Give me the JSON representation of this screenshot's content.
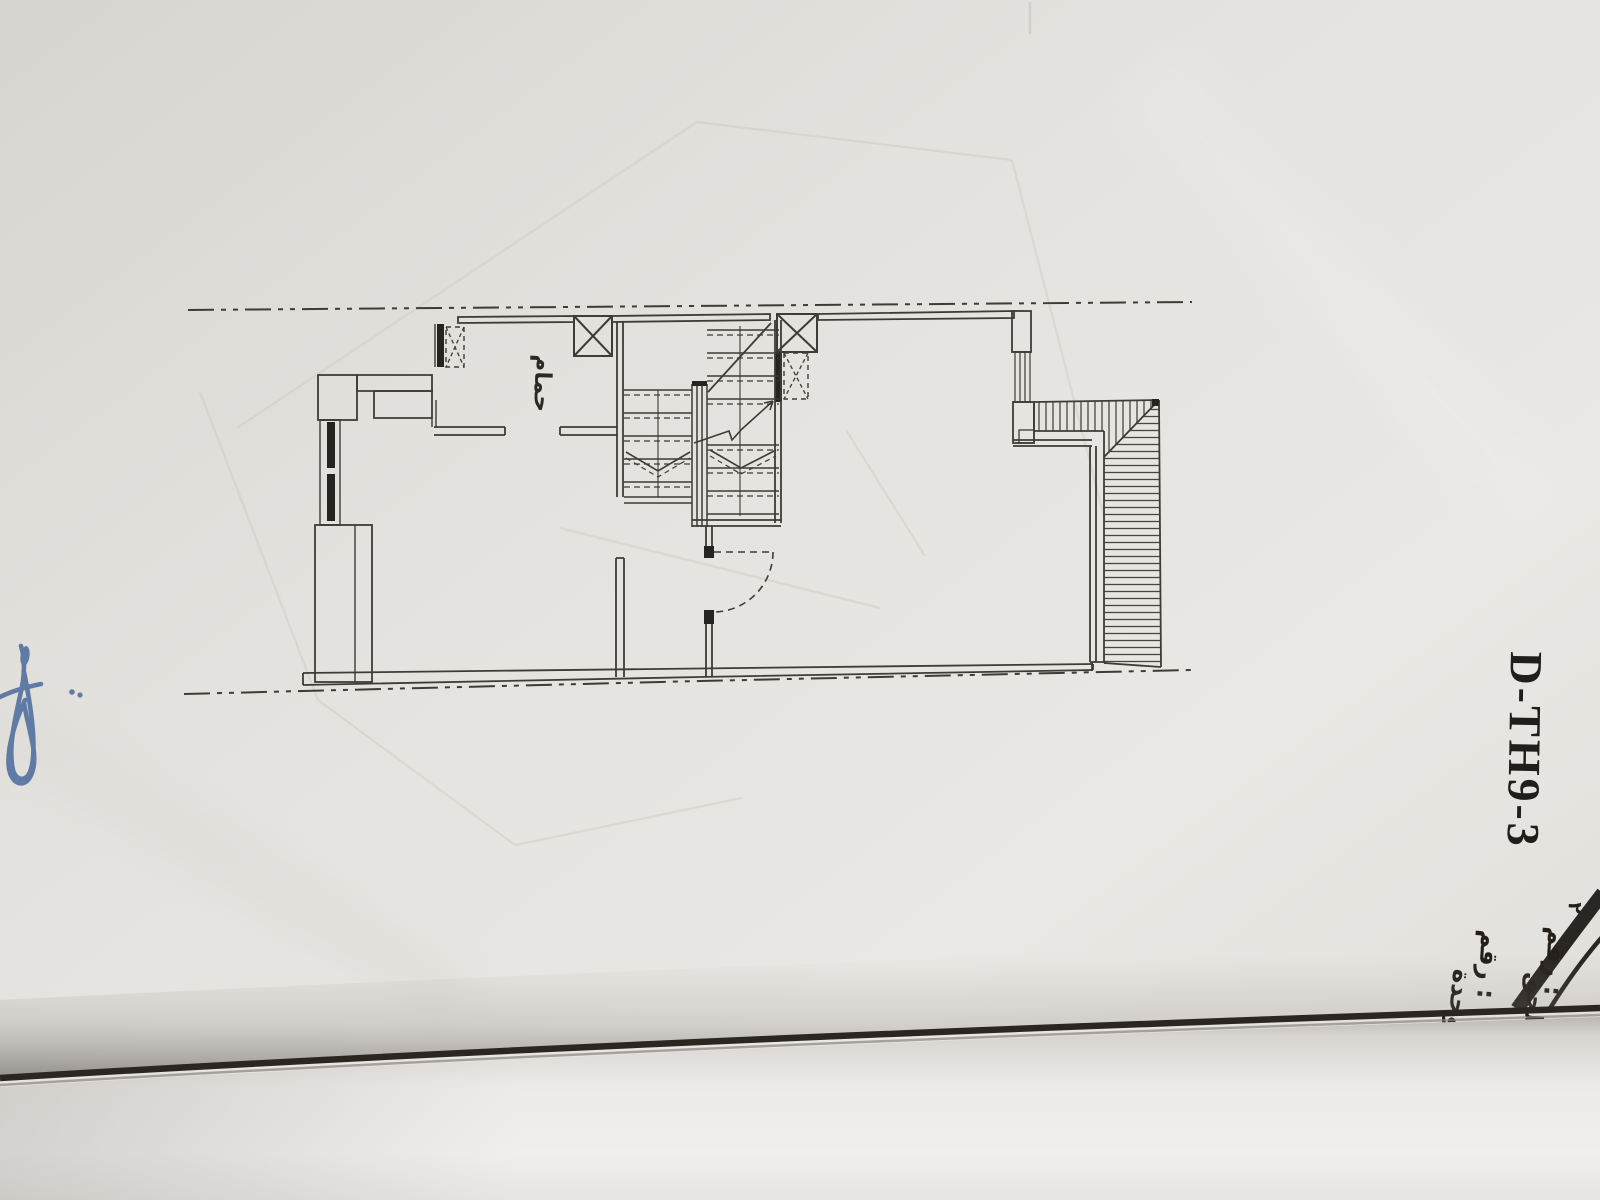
{
  "page": {
    "sheet_code": "D-TH9-3",
    "plan": {
      "room_label": "حمام"
    },
    "annotations": {
      "number_mark": "٢",
      "right_column": {
        "top_word": "رقم :",
        "bottom_word": "ملحق"
      },
      "left_column": {
        "top_word": "رقم :",
        "bottom_word": "وحدة"
      }
    },
    "colors": {
      "paper": "#e4e1dd",
      "ink": "#3f3b36",
      "signature_blue": "#4e6e9e",
      "under_surface": "#edecea",
      "curl_line": "#2b2620"
    }
  }
}
